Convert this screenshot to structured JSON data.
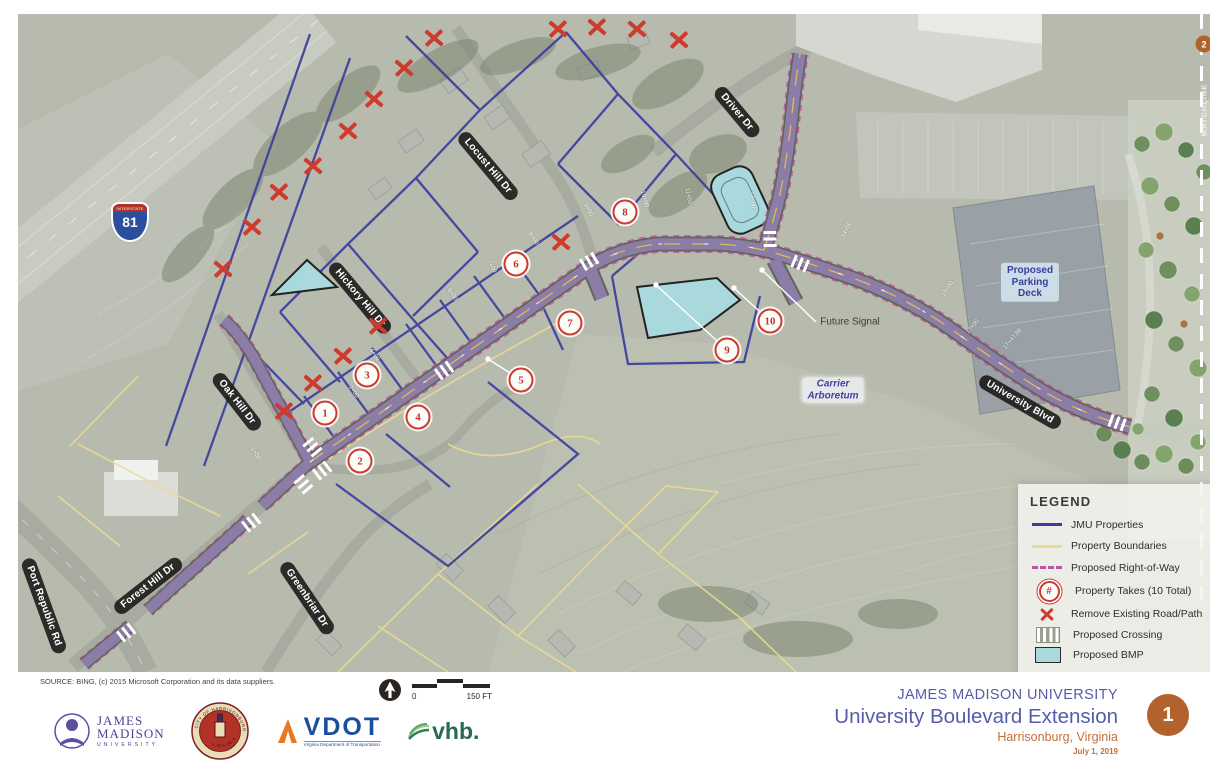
{
  "colors": {
    "jmu_property_line": "#3d3a9e",
    "property_boundary": "#ecd992",
    "right_of_way_dash": "#c0549e",
    "take_red": "#ce3b2e",
    "bmp_fill": "#a9d8dd",
    "road_purple": "#8b7da8",
    "title_purple": "#575ca8",
    "accent_orange": "#b2622d"
  },
  "map": {
    "interstate_shield": {
      "top": "INTERSTATE",
      "number": "81"
    },
    "street_labels": [
      {
        "text": "Locust Hill Dr",
        "x": 470,
        "y": 152,
        "rot": 50
      },
      {
        "text": "Hickory Hill Dr",
        "x": 342,
        "y": 284,
        "rot": 50
      },
      {
        "text": "Oak Hill Dr",
        "x": 219,
        "y": 388,
        "rot": 52
      },
      {
        "text": "Forest Hill Dr",
        "x": 130,
        "y": 572,
        "rot": -38
      },
      {
        "text": "Greenbriar Dr",
        "x": 289,
        "y": 584,
        "rot": 56
      },
      {
        "text": "Port Republic Rd",
        "x": 26,
        "y": 592,
        "rot": 70
      },
      {
        "text": "Driver Dr",
        "x": 719,
        "y": 98,
        "rot": 50
      },
      {
        "text": "University Blvd",
        "x": 1002,
        "y": 388,
        "rot": 30
      }
    ],
    "area_labels": [
      {
        "text": "Carrier Arboretum",
        "lines": "Carrier\nArboretum",
        "x": 815,
        "y": 376,
        "variant": "arboretum"
      },
      {
        "text": "Proposed Parking Deck",
        "lines": "Proposed\nParking\nDeck",
        "x": 1012,
        "y": 268,
        "variant": "deck"
      },
      {
        "text": "Future Signal",
        "lines": "Future Signal",
        "x": 832,
        "y": 308,
        "variant": "callout"
      }
    ],
    "matchline": {
      "label": "MATCHLINE",
      "sheet": "2"
    },
    "property_takes": [
      {
        "n": "1",
        "x": 307,
        "y": 399
      },
      {
        "n": "2",
        "x": 342,
        "y": 447
      },
      {
        "n": "3",
        "x": 349,
        "y": 361
      },
      {
        "n": "4",
        "x": 400,
        "y": 403
      },
      {
        "n": "5",
        "x": 503,
        "y": 366
      },
      {
        "n": "6",
        "x": 498,
        "y": 250
      },
      {
        "n": "7",
        "x": 552,
        "y": 309
      },
      {
        "n": "8",
        "x": 607,
        "y": 198
      },
      {
        "n": "9",
        "x": 709,
        "y": 336
      },
      {
        "n": "10",
        "x": 752,
        "y": 307
      }
    ],
    "remove_marks": [
      {
        "x": 416,
        "y": 24
      },
      {
        "x": 386,
        "y": 54
      },
      {
        "x": 356,
        "y": 85
      },
      {
        "x": 330,
        "y": 117
      },
      {
        "x": 295,
        "y": 152
      },
      {
        "x": 261,
        "y": 178
      },
      {
        "x": 234,
        "y": 213
      },
      {
        "x": 205,
        "y": 255
      },
      {
        "x": 540,
        "y": 15
      },
      {
        "x": 579,
        "y": 13
      },
      {
        "x": 619,
        "y": 15
      },
      {
        "x": 661,
        "y": 26
      },
      {
        "x": 543,
        "y": 228
      },
      {
        "x": 360,
        "y": 312
      },
      {
        "x": 325,
        "y": 342
      },
      {
        "x": 295,
        "y": 369
      },
      {
        "x": 266,
        "y": 397
      }
    ],
    "crossings": [
      {
        "x": 295,
        "y": 434,
        "rot": 50
      },
      {
        "x": 305,
        "y": 456,
        "rot": -38
      },
      {
        "x": 286,
        "y": 471,
        "rot": 50
      },
      {
        "x": 234,
        "y": 508,
        "rot": -38
      },
      {
        "x": 109,
        "y": 618,
        "rot": -38
      },
      {
        "x": 427,
        "y": 356,
        "rot": -35
      },
      {
        "x": 572,
        "y": 247,
        "rot": -30
      },
      {
        "x": 752,
        "y": 226,
        "rot": 88
      },
      {
        "x": 783,
        "y": 250,
        "rot": 22
      },
      {
        "x": 1100,
        "y": 409,
        "rot": 20
      }
    ],
    "stations": [
      {
        "text": "1+00",
        "x": 237,
        "y": 440,
        "rot": 55
      },
      {
        "text": "3+00",
        "x": 335,
        "y": 378,
        "rot": 55
      },
      {
        "text": "4+00",
        "x": 356,
        "y": 341,
        "rot": 55
      },
      {
        "text": "6+00",
        "x": 434,
        "y": 281,
        "rot": 55
      },
      {
        "text": "7+00",
        "x": 473,
        "y": 253,
        "rot": 55
      },
      {
        "text": "8+00",
        "x": 515,
        "y": 225,
        "rot": 55
      },
      {
        "text": "9+00",
        "x": 570,
        "y": 196,
        "rot": 60
      },
      {
        "text": "10+00",
        "x": 626,
        "y": 185,
        "rot": 75
      },
      {
        "text": "11+00",
        "x": 670,
        "y": 182,
        "rot": 80
      },
      {
        "text": "12+00",
        "x": 734,
        "y": 186,
        "rot": 85
      },
      {
        "text": "14+00",
        "x": 829,
        "y": 216,
        "rot": -65
      },
      {
        "text": "16+00",
        "x": 930,
        "y": 275,
        "rot": -55
      },
      {
        "text": "17+00",
        "x": 955,
        "y": 313,
        "rot": -50
      },
      {
        "text": "17+47.86",
        "x": 995,
        "y": 325,
        "rot": -50
      }
    ]
  },
  "legend": {
    "title": "LEGEND",
    "items": [
      {
        "label": "JMU Properties",
        "symbol": "line-blue"
      },
      {
        "label": "Property Boundaries",
        "symbol": "line-yellow"
      },
      {
        "label": "Proposed Right-of-Way",
        "symbol": "dash"
      },
      {
        "label": "Property Takes (10 Total)",
        "symbol": "take"
      },
      {
        "label": "Remove Existing Road/Path",
        "symbol": "x"
      },
      {
        "label": "Proposed Crossing",
        "symbol": "crossing"
      },
      {
        "label": "Proposed BMP",
        "symbol": "bmp"
      }
    ],
    "take_symbol_text": "#"
  },
  "footer": {
    "source": "SOURCE:  BING, (c) 2015 Microsoft Corporation and its data suppliers.",
    "scale": {
      "zero": "0",
      "label": "150 FT"
    },
    "logos": {
      "jmu": {
        "line1": "JAMES",
        "line2": "MADISON",
        "line3": "UNIVERSITY."
      },
      "seal": {
        "arc_top": "CITY OF HARRISONBURG",
        "arc_bottom": "VIRGINIA"
      },
      "vdot": {
        "name": "VDOT",
        "tagline": "Virginia Department of Transportation"
      },
      "vhb": {
        "name": "vhb."
      }
    },
    "title_block": {
      "org": "JAMES MADISON UNIVERSITY",
      "title": "University Boulevard Extension",
      "location": "Harrisonburg, Virginia",
      "date": "July 1, 2019",
      "sheet": "1"
    }
  }
}
